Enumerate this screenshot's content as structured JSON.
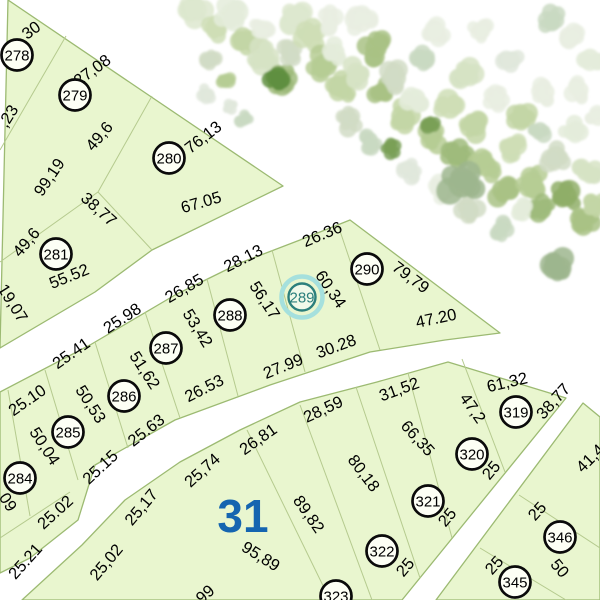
{
  "map": {
    "colors": {
      "background": "#ffffff",
      "parcel_fill": "#e9f6cf",
      "block_border": "#9cba72",
      "inner_line": "#b5ca8e",
      "text": "#000000",
      "marker_stroke": "#0a0a0a",
      "marker_fill": "#fdfff5",
      "highlight_ring": "#a5e0dd",
      "highlight_stroke": "#2b7f7c",
      "highlight_fill": "#f0f9e9",
      "block_label_blue": "#1565b0"
    },
    "area_label": {
      "t": "31",
      "x": 243,
      "y": 516
    },
    "blocks": [
      {
        "name": "block-278-281",
        "points": [
          [
            8,
            0
          ],
          [
            283,
            186
          ],
          [
            152,
            250
          ],
          [
            95,
            292
          ],
          [
            0,
            348
          ]
        ]
      },
      {
        "name": "block-284-290",
        "points": [
          [
            0,
            392
          ],
          [
            90,
            345
          ],
          [
            175,
            295
          ],
          [
            240,
            263
          ],
          [
            300,
            240
          ],
          [
            350,
            220
          ],
          [
            500,
            333
          ],
          [
            445,
            340
          ],
          [
            370,
            352
          ],
          [
            270,
            385
          ],
          [
            175,
            420
          ],
          [
            95,
            465
          ],
          [
            78,
            520
          ],
          [
            30,
            558
          ],
          [
            0,
            573
          ]
        ]
      },
      {
        "name": "block-31",
        "points": [
          [
            22,
            600
          ],
          [
            82,
            545
          ],
          [
            125,
            500
          ],
          [
            180,
            462
          ],
          [
            240,
            430
          ],
          [
            300,
            402
          ],
          [
            377,
            382
          ],
          [
            448,
            362
          ],
          [
            566,
            398
          ],
          [
            402,
            600
          ]
        ]
      },
      {
        "name": "block-345-346",
        "points": [
          [
            436,
            600
          ],
          [
            583,
            403
          ],
          [
            600,
            417
          ],
          [
            600,
            600
          ]
        ]
      }
    ],
    "boundary_lines": [
      [
        66,
        36,
        0,
        150
      ],
      [
        152,
        96,
        98,
        192
      ],
      [
        98,
        192,
        0,
        262
      ],
      [
        98,
        192,
        152,
        250
      ],
      [
        8,
        390,
        30,
        516
      ],
      [
        45,
        370,
        78,
        480
      ],
      [
        95,
        342,
        128,
        448
      ],
      [
        145,
        312,
        180,
        418
      ],
      [
        207,
        279,
        238,
        396
      ],
      [
        272,
        250,
        305,
        372
      ],
      [
        338,
        225,
        380,
        350
      ],
      [
        0,
        538,
        70,
        492
      ],
      [
        247,
        430,
        330,
        600
      ],
      [
        300,
        405,
        372,
        600
      ],
      [
        356,
        387,
        420,
        578
      ],
      [
        408,
        373,
        452,
        538
      ],
      [
        462,
        359,
        505,
        472
      ],
      [
        519,
        495,
        600,
        548
      ],
      [
        480,
        548,
        566,
        600
      ]
    ],
    "parcels": [
      {
        "id": "278",
        "x": 17,
        "y": 55,
        "highlight": false
      },
      {
        "id": "279",
        "x": 75,
        "y": 95,
        "highlight": false
      },
      {
        "id": "280",
        "x": 169,
        "y": 158,
        "highlight": false
      },
      {
        "id": "281",
        "x": 56,
        "y": 254,
        "highlight": false
      },
      {
        "id": "284",
        "x": 20,
        "y": 478,
        "highlight": false
      },
      {
        "id": "285",
        "x": 68,
        "y": 432,
        "highlight": false
      },
      {
        "id": "286",
        "x": 124,
        "y": 396,
        "highlight": false
      },
      {
        "id": "287",
        "x": 166,
        "y": 348,
        "highlight": false
      },
      {
        "id": "288",
        "x": 230,
        "y": 315,
        "highlight": false
      },
      {
        "id": "289",
        "x": 302,
        "y": 297,
        "highlight": true
      },
      {
        "id": "290",
        "x": 367,
        "y": 269,
        "highlight": false
      },
      {
        "id": "319",
        "x": 516,
        "y": 412,
        "highlight": false
      },
      {
        "id": "320",
        "x": 472,
        "y": 454,
        "highlight": false
      },
      {
        "id": "321",
        "x": 428,
        "y": 501,
        "highlight": false
      },
      {
        "id": "322",
        "x": 382,
        "y": 551,
        "highlight": false
      },
      {
        "id": "323",
        "x": 336,
        "y": 596,
        "highlight": false
      },
      {
        "id": "345",
        "x": 515,
        "y": 582,
        "highlight": false
      },
      {
        "id": "346",
        "x": 560,
        "y": 537,
        "highlight": false
      }
    ],
    "dim_labels": [
      {
        "t": "30",
        "x": 31,
        "y": 30,
        "r": -37
      },
      {
        "t": "27,08",
        "x": 92,
        "y": 70,
        "r": -36
      },
      {
        "t": "76,13",
        "x": 203,
        "y": 137,
        "r": -38
      },
      {
        "t": "67.05",
        "x": 201,
        "y": 202,
        "r": -16
      },
      {
        "t": ",23",
        "x": 8,
        "y": 116,
        "r": -58
      },
      {
        "t": "49,6",
        "x": 99,
        "y": 136,
        "r": -50
      },
      {
        "t": "99,19",
        "x": 49,
        "y": 177,
        "r": -56
      },
      {
        "t": "38,77",
        "x": 99,
        "y": 209,
        "r": 42
      },
      {
        "t": "49,6",
        "x": 26,
        "y": 242,
        "r": -50
      },
      {
        "t": "55.52",
        "x": 69,
        "y": 276,
        "r": -22
      },
      {
        "t": "19,07",
        "x": 13,
        "y": 303,
        "r": 58
      },
      {
        "t": "25.10",
        "x": 27,
        "y": 400,
        "r": -35
      },
      {
        "t": "25.41",
        "x": 71,
        "y": 353,
        "r": -35
      },
      {
        "t": "25.98",
        "x": 122,
        "y": 318,
        "r": -33
      },
      {
        "t": "26,85",
        "x": 184,
        "y": 288,
        "r": -30
      },
      {
        "t": "28.13",
        "x": 243,
        "y": 258,
        "r": -27
      },
      {
        "t": "26.36",
        "x": 322,
        "y": 234,
        "r": -23
      },
      {
        "t": "79,79",
        "x": 411,
        "y": 277,
        "r": 37
      },
      {
        "t": "47.20",
        "x": 436,
        "y": 318,
        "r": -12
      },
      {
        "t": "60,34",
        "x": 331,
        "y": 289,
        "r": 56
      },
      {
        "t": "56,17",
        "x": 265,
        "y": 300,
        "r": 57
      },
      {
        "t": "53,42",
        "x": 198,
        "y": 328,
        "r": 58
      },
      {
        "t": "51,62",
        "x": 145,
        "y": 370,
        "r": 57
      },
      {
        "t": "50,53",
        "x": 91,
        "y": 404,
        "r": 57
      },
      {
        "t": "50,04",
        "x": 45,
        "y": 446,
        "r": 57
      },
      {
        "t": ",09",
        "x": 7,
        "y": 500,
        "r": 57
      },
      {
        "t": "25.02",
        "x": 55,
        "y": 512,
        "r": -42
      },
      {
        "t": "25.15",
        "x": 100,
        "y": 467,
        "r": -43
      },
      {
        "t": "25.63",
        "x": 146,
        "y": 430,
        "r": -38
      },
      {
        "t": "26.53",
        "x": 204,
        "y": 388,
        "r": -27
      },
      {
        "t": "27.99",
        "x": 283,
        "y": 366,
        "r": -22
      },
      {
        "t": "30.28",
        "x": 336,
        "y": 346,
        "r": -20
      },
      {
        "t": "25.21",
        "x": 25,
        "y": 561,
        "r": -48
      },
      {
        "t": "25,02",
        "x": 106,
        "y": 562,
        "r": -50
      },
      {
        "t": "25,17",
        "x": 141,
        "y": 507,
        "r": -50
      },
      {
        "t": "25,74",
        "x": 202,
        "y": 470,
        "r": -42
      },
      {
        "t": "26,81",
        "x": 258,
        "y": 439,
        "r": -35
      },
      {
        "t": "28,59",
        "x": 323,
        "y": 409,
        "r": -25
      },
      {
        "t": "31,52",
        "x": 399,
        "y": 389,
        "r": -20
      },
      {
        "t": "61,32",
        "x": 507,
        "y": 382,
        "r": -13
      },
      {
        "t": "95,89",
        "x": 261,
        "y": 556,
        "r": 32
      },
      {
        "t": "89,82",
        "x": 309,
        "y": 514,
        "r": 55
      },
      {
        "t": "80,18",
        "x": 364,
        "y": 473,
        "r": 53
      },
      {
        "t": "66,35",
        "x": 418,
        "y": 438,
        "r": 48
      },
      {
        "t": "47,2",
        "x": 473,
        "y": 408,
        "r": 55
      },
      {
        "t": "99",
        "x": 205,
        "y": 594,
        "r": -42
      },
      {
        "t": "38,77",
        "x": 553,
        "y": 401,
        "r": -48
      },
      {
        "t": "25",
        "x": 491,
        "y": 470,
        "r": -50
      },
      {
        "t": "25",
        "x": 447,
        "y": 517,
        "r": -50
      },
      {
        "t": "25",
        "x": 405,
        "y": 567,
        "r": -50
      },
      {
        "t": "41,4",
        "x": 590,
        "y": 458,
        "r": -45
      },
      {
        "t": "25",
        "x": 537,
        "y": 511,
        "r": -48
      },
      {
        "t": "25",
        "x": 494,
        "y": 565,
        "r": -48
      },
      {
        "t": "50",
        "x": 560,
        "y": 568,
        "r": 50
      }
    ],
    "vegetation": {
      "palette": [
        "#dde8cf",
        "#cfdeb6",
        "#c3d6a6",
        "#e4ecda",
        "#d6e3c4",
        "#b6cd94",
        "#a9c285",
        "#d1dcc6",
        "#e9efe2",
        "#9fbb7b",
        "#8fae69",
        "#c9d9c2",
        "#e1e8dc",
        "#5f8f3f",
        "#7aa057",
        "#9db68e"
      ],
      "trees": [
        [
          196,
          10,
          15,
          0
        ],
        [
          214,
          28,
          13,
          1
        ],
        [
          232,
          14,
          16,
          3
        ],
        [
          248,
          40,
          14,
          2
        ],
        [
          264,
          58,
          15,
          4
        ],
        [
          280,
          78,
          14,
          9
        ],
        [
          262,
          28,
          11,
          8
        ],
        [
          290,
          52,
          13,
          7
        ],
        [
          297,
          18,
          15,
          0
        ],
        [
          312,
          38,
          14,
          1
        ],
        [
          322,
          66,
          15,
          5
        ],
        [
          336,
          52,
          12,
          3
        ],
        [
          342,
          88,
          14,
          2
        ],
        [
          356,
          72,
          13,
          4
        ],
        [
          362,
          22,
          14,
          8
        ],
        [
          376,
          48,
          15,
          6
        ],
        [
          382,
          92,
          13,
          6
        ],
        [
          396,
          78,
          14,
          7
        ],
        [
          402,
          116,
          15,
          2
        ],
        [
          416,
          98,
          13,
          3
        ],
        [
          422,
          58,
          12,
          11
        ],
        [
          432,
          136,
          14,
          5
        ],
        [
          436,
          33,
          13,
          8
        ],
        [
          450,
          108,
          15,
          1
        ],
        [
          456,
          156,
          13,
          9
        ],
        [
          466,
          73,
          14,
          4
        ],
        [
          476,
          126,
          14,
          2
        ],
        [
          486,
          166,
          15,
          5
        ],
        [
          496,
          98,
          12,
          8
        ],
        [
          502,
          190,
          14,
          6
        ],
        [
          512,
          146,
          13,
          1
        ],
        [
          522,
          118,
          14,
          2
        ],
        [
          532,
          182,
          15,
          5
        ],
        [
          542,
          210,
          13,
          9
        ],
        [
          546,
          92,
          12,
          8
        ],
        [
          556,
          156,
          14,
          7
        ],
        [
          566,
          196,
          15,
          10
        ],
        [
          572,
          132,
          12,
          3
        ],
        [
          582,
          222,
          14,
          6
        ],
        [
          586,
          172,
          13,
          4
        ],
        [
          596,
          206,
          12,
          2
        ],
        [
          598,
          118,
          11,
          8
        ],
        [
          590,
          58,
          13,
          3
        ],
        [
          572,
          38,
          12,
          8
        ],
        [
          552,
          20,
          12,
          11
        ],
        [
          330,
          20,
          12,
          8
        ],
        [
          350,
          120,
          12,
          7
        ],
        [
          370,
          140,
          11,
          11
        ],
        [
          410,
          170,
          12,
          12
        ],
        [
          440,
          190,
          12,
          8
        ],
        [
          470,
          210,
          12,
          7
        ],
        [
          500,
          230,
          11,
          11
        ],
        [
          520,
          210,
          11,
          3
        ],
        [
          480,
          30,
          11,
          8
        ],
        [
          510,
          60,
          12,
          12
        ],
        [
          540,
          130,
          11,
          11
        ],
        [
          580,
          90,
          12,
          8
        ],
        [
          278,
          76,
          13,
          13
        ],
        [
          390,
          148,
          9,
          14
        ],
        [
          462,
          184,
          19,
          15
        ],
        [
          560,
          268,
          16,
          15
        ],
        [
          430,
          124,
          10,
          14
        ],
        [
          205,
          94,
          9,
          12
        ],
        [
          230,
          106,
          7,
          12
        ],
        [
          244,
          120,
          8,
          11
        ],
        [
          210,
          60,
          10,
          7
        ],
        [
          226,
          80,
          9,
          5
        ]
      ]
    }
  }
}
